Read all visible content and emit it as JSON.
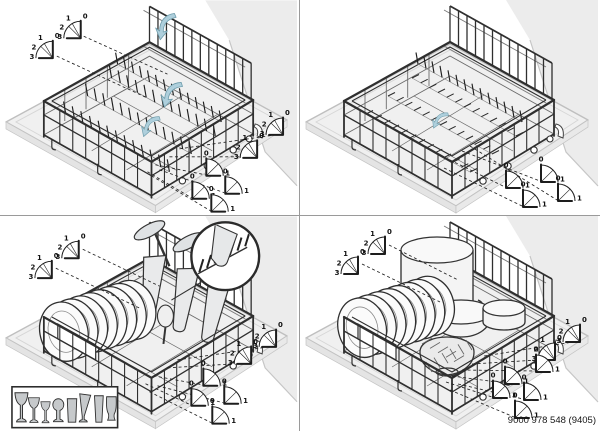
{
  "figure": {
    "doc_number": "9000 978 548 (9405)",
    "position_labels": {
      "p0": "0",
      "p1": "1",
      "p2": "2",
      "p3": "3"
    },
    "colors": {
      "line": "#2f2f2f",
      "divider": "#9a9a9a",
      "platform": "#f0f0f0",
      "wall": "#ececec",
      "arrow_fill": "#aecfdc",
      "arrow_stroke": "#6f9dac",
      "glass_fill": "#c6c9cb",
      "dish_fill": "#fbfbfb"
    },
    "panels": [
      {
        "name": "lower-rack-fold-down-tines"
      },
      {
        "name": "lower-rack-tines-folded"
      },
      {
        "name": "lower-rack-loaded-glassware"
      },
      {
        "name": "lower-rack-loaded-cookware"
      }
    ],
    "legend_items": [
      "wine-glass-large-icon",
      "wine-glass-icon",
      "wine-glass-small-icon",
      "goblet-icon",
      "tumbler-icon",
      "pilsner-glass-icon",
      "tall-glass-icon",
      "vase-icon"
    ]
  }
}
